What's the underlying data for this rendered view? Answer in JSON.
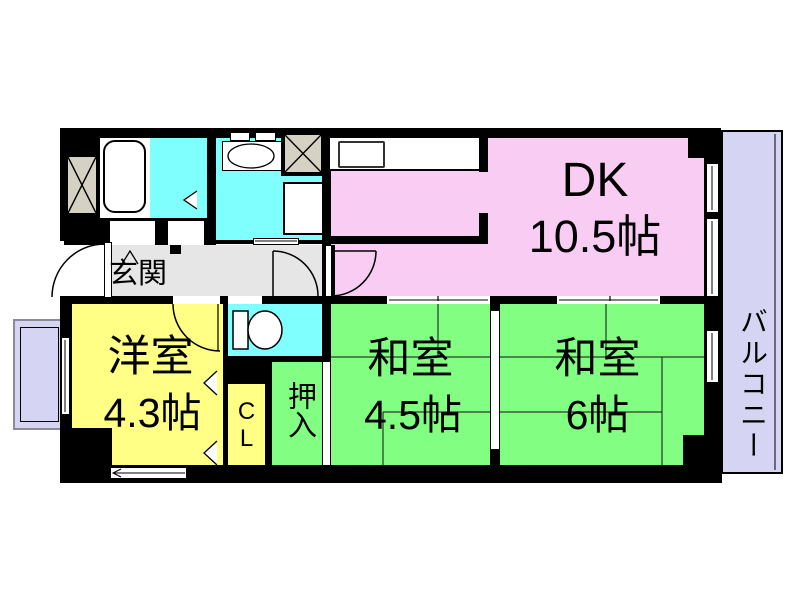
{
  "rooms": {
    "dk": {
      "label": "DK",
      "size": "10.5帖"
    },
    "balcony_right": {
      "label": "バルコニー"
    },
    "western_room": {
      "label": "洋室",
      "size": "4.3帖"
    },
    "japanese_room_45": {
      "label": "和室",
      "size": "4.5帖"
    },
    "japanese_room_6": {
      "label": "和室",
      "size": "6帖"
    },
    "entrance": {
      "label": "玄関"
    },
    "closet": {
      "label": "CL"
    },
    "oshiire_closet": {
      "label": "押入"
    }
  },
  "fixtures": [
    "bathtub",
    "vanity-basin",
    "washing-machine-pan",
    "toilet",
    "kitchen-counter",
    "kitchen-sink",
    "shaft-x-box",
    "shaft-x-box",
    "entrance-door-arc",
    "hall-door-arc",
    "dk-door-arc",
    "western-room-door-arc"
  ],
  "colors": {
    "wall": "#000000",
    "dk": "#F9CDF3",
    "tatami_room": "#82FF82",
    "western_room": "#FFFF85",
    "wet_area": "#80FFFF",
    "balcony": "#D5D5F3",
    "hallway": "#E6E6E6",
    "shaft": "#D6D2C3",
    "floor": "#FFFFFF"
  }
}
